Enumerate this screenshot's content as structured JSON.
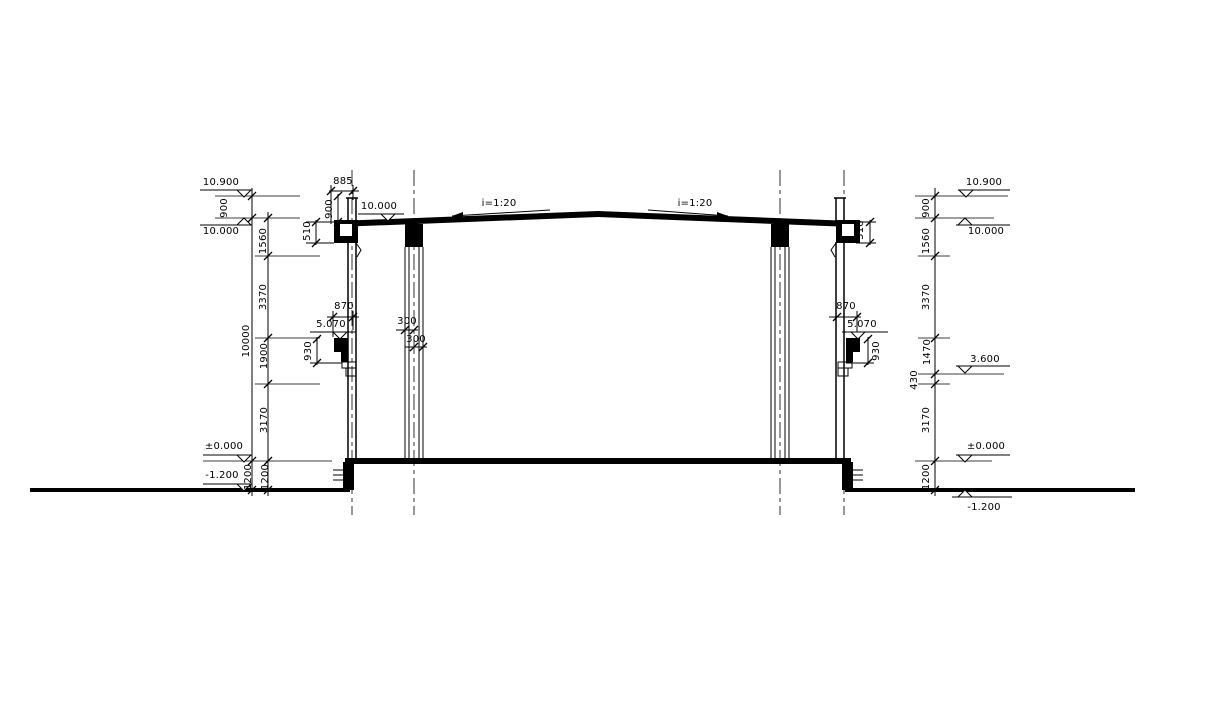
{
  "drawing": {
    "type": "building cross-section",
    "line_color": "#000000",
    "background_color": "#ffffff"
  },
  "left": {
    "elevations": {
      "top": "10.900",
      "roof": "10.000",
      "floor": "±0.000",
      "ground": "-1.200"
    },
    "outer_dims": {
      "parapet": "900",
      "overall": "10000",
      "below_floor": "1200"
    },
    "inner_dims": {
      "s1": "1560",
      "s2": "3370",
      "s3": "1900",
      "s4": "3170",
      "s5": "1200"
    }
  },
  "right": {
    "elevations": {
      "top": "10.900",
      "roof": "10.000",
      "mid": "3.600",
      "floor": "±0.000",
      "ground": "-1.200"
    },
    "dims": {
      "s0": "900",
      "s1": "1560",
      "s2": "3370",
      "s3": "1470",
      "s4": "430",
      "s5": "3170",
      "s6": "1200"
    }
  },
  "wall_left": {
    "parapet_width": "885",
    "parapet_height": "900",
    "gutter": "510",
    "corbel_width": "870",
    "corbel_elev": "5.070",
    "corbel_height": "930"
  },
  "wall_right": {
    "gutter": "510",
    "corbel_width": "870",
    "corbel_elev": "5.070",
    "corbel_height": "930"
  },
  "roof": {
    "elev": "10.000",
    "slope_left": "i=1:20",
    "slope_right": "i=1:20"
  },
  "column": {
    "width_a": "300",
    "width_b": "300"
  }
}
